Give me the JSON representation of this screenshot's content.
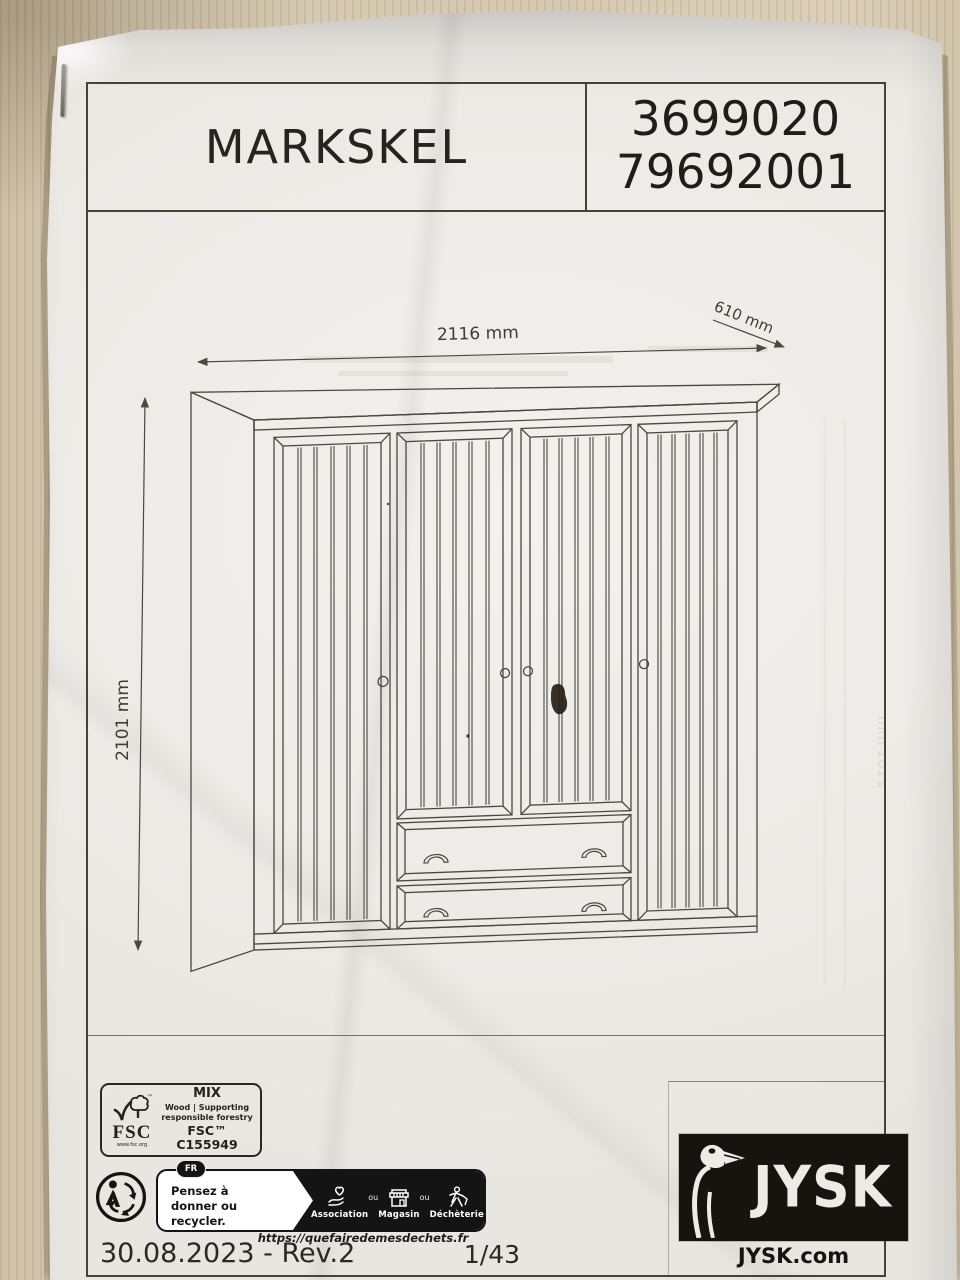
{
  "page": {
    "product_name": "MARKSKEL",
    "article_number": "3699020",
    "model_number": "79692001"
  },
  "drawing": {
    "width_label": "2116 mm",
    "depth_label": "610 mm",
    "height_label": "2101 mm"
  },
  "certification": {
    "fsc_acronym": "FSC",
    "fsc_trademark": "™",
    "fsc_url": "www.fsc.org",
    "mix_label": "MIX",
    "claim_line1": "Wood | Supporting",
    "claim_line2": "responsible forestry",
    "license_code": "FSC™ C155949"
  },
  "recycling": {
    "country_badge": "FR",
    "message_line1": "Pensez à",
    "message_line2": "donner ou recycler.",
    "separator": "ou",
    "options": [
      {
        "label": "Association"
      },
      {
        "label": "Magasin"
      },
      {
        "label": "Déchèterie"
      }
    ],
    "url": "https://quefairedemesdechets.fr"
  },
  "brand": {
    "name": "JYSK",
    "website": "JYSK.com"
  },
  "footer": {
    "date_revision": "30.08.2023 - Rev.2",
    "page_indicator": "1/43"
  },
  "colors": {
    "ink": "#2a2724",
    "line": "#4b4843",
    "brand_block": "#17130f",
    "paper": "#e9e6e1",
    "desk": "#d6c9b0"
  }
}
